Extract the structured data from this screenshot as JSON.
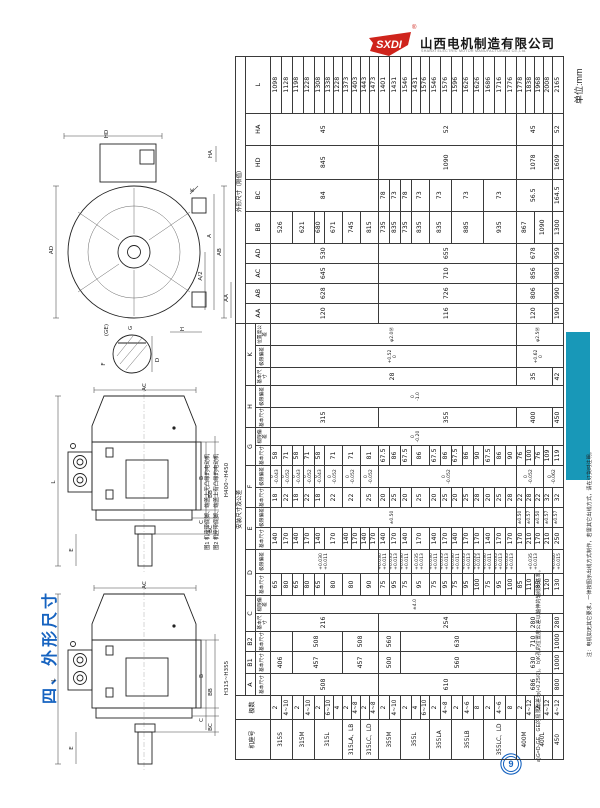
{
  "page": {
    "unit_label": "单位:mm",
    "section_title": "四、外形尺寸",
    "page_number": "9"
  },
  "logo": {
    "mark_text": "SXDI",
    "reg_mark": "®",
    "company_cn": "山西电机制造有限公司",
    "company_en": "SHANXI ELECTRIC MOTOR MANUFACTURING Co.,Ltd."
  },
  "colors": {
    "accent_blue": "#1663c0",
    "teal_bar": "#1898b8",
    "logo_red": "#cf241c"
  },
  "drawings": {
    "caption_line1": "图1 机座带底脚、端盖上无凸缘的电动机",
    "caption_line2": "图2 机座带底脚、端盖上有凸缘的电动机",
    "front_view": {
      "labels": {
        "hd": "HD",
        "ad": "AD",
        "ha": "HA",
        "k": "K",
        "ab": "AB",
        "a": "A",
        "a2": "A/2",
        "aa": "AA",
        "h": "H"
      }
    },
    "shaft_detail": {
      "labels": {
        "ge": "(GE)",
        "g": "G",
        "f": "F",
        "d": "D"
      }
    },
    "side_view_top": {
      "range_label": "H400~H450",
      "labels": {
        "ac": "AC",
        "l": "L",
        "e": "E",
        "b": "B",
        "bb": "BB",
        "c": "C",
        "bc": "BC"
      }
    },
    "side_view_bottom": {
      "range_label": "H315~H355",
      "labels": {
        "ac": "AC",
        "l": "L",
        "e": "E",
        "b": "B",
        "bb": "BB",
        "c": "C",
        "bc": "BC"
      }
    }
  },
  "notes": {
    "note_ab": "a)G=D-GE，GE的极限偏差为(+0.25/0)。 b)K孔的位置度公差以轴伸的轴线为基准。",
    "note_order": "注：电机如无其它要求，一律按图示出线方式制作，若需其它出线方式，请在订货时注明。"
  },
  "table": {
    "group_headers": {
      "install": "安装尺寸及公差",
      "overall": "外形尺寸（限值）"
    },
    "corner_headers": {
      "frame": "机座号",
      "poles": "极数"
    },
    "sub_labels": {
      "basic": "基本尺寸",
      "dev": "极限偏差",
      "pos": "位置度公差"
    },
    "letter_groups": [
      {
        "label": "A",
        "span": 1
      },
      {
        "label": "B1",
        "span": 1
      },
      {
        "label": "B2",
        "span": 1
      },
      {
        "label": "C",
        "span": 2
      },
      {
        "label": "D",
        "span": 2
      },
      {
        "label": "E",
        "span": 2
      },
      {
        "label": "F",
        "span": 2
      },
      {
        "label": "G",
        "span": 2
      },
      {
        "label": "H",
        "span": 2
      },
      {
        "label": "K",
        "span": 3
      }
    ],
    "overall_letters": [
      "AA",
      "AB",
      "AC",
      "AD",
      "BB",
      "BC",
      "HD",
      "HA",
      "L"
    ],
    "col_widths": [
      40,
      24,
      22,
      22,
      20,
      18,
      18,
      22,
      24,
      22,
      20,
      20,
      22,
      20,
      18,
      20,
      22,
      18,
      22,
      22,
      20,
      20,
      20,
      20,
      32,
      32,
      34,
      32,
      57
    ],
    "column_order": [
      "A",
      "B1",
      "B2",
      "C",
      "C_dev",
      "D",
      "D_dev",
      "E",
      "E_dev",
      "F",
      "F_dev",
      "G",
      "G_dev",
      "H",
      "H_dev",
      "K",
      "K_dev",
      "K_pos",
      "AA",
      "AB",
      "AC",
      "AD",
      "BB",
      "BC",
      "HD",
      "HA",
      "L"
    ],
    "frames": [
      {
        "name": "315S",
        "poles": [
          "2",
          "4~10"
        ]
      },
      {
        "name": "315M",
        "poles": [
          "2",
          "4~10"
        ]
      },
      {
        "name": "315L",
        "poles": [
          "2",
          "6~10",
          "4"
        ]
      },
      {
        "name": "315LA、LB",
        "poles": [
          "2",
          "4~8"
        ]
      },
      {
        "name": "315LC、LD",
        "poles": [
          "2",
          "4~8"
        ]
      },
      {
        "name": "355M",
        "poles": [
          "2",
          "4~10"
        ]
      },
      {
        "name": "355L",
        "poles": [
          "2",
          "4",
          "6~10"
        ]
      },
      {
        "name": "355LA",
        "poles": [
          "2",
          "4~8"
        ]
      },
      {
        "name": "355LB",
        "poles": [
          "2",
          "4~6",
          "8"
        ]
      },
      {
        "name": "355LC、LD",
        "poles": [
          "2",
          "4~6",
          "8"
        ]
      },
      {
        "name": "400M",
        "poles": [
          "2",
          "4~12"
        ]
      },
      {
        "name": "400L",
        "poles": [
          "2",
          "4~12"
        ]
      },
      {
        "name": "450",
        "poles": [
          "4~12"
        ]
      }
    ],
    "columns": {
      "A": [
        [
          "508",
          11
        ],
        [
          "610",
          13
        ],
        [
          "686",
          4
        ],
        [
          "800",
          1
        ]
      ],
      "B1": [
        [
          "406",
          2
        ],
        [
          "457",
          5
        ],
        [
          "457",
          4
        ],
        [
          "500",
          2
        ],
        [
          "560",
          11
        ],
        [
          "630",
          4
        ],
        [
          "1000",
          1
        ]
      ],
      "B2": [
        [
          "",
          2
        ],
        [
          "508",
          5
        ],
        [
          "508",
          4
        ],
        [
          "560",
          2
        ],
        [
          "630",
          11
        ],
        [
          "710",
          4
        ],
        [
          "1000",
          1
        ]
      ],
      "C": [
        [
          "216",
          11
        ],
        [
          "254",
          13
        ],
        [
          "280",
          4
        ],
        [
          "280",
          1
        ]
      ],
      "C_dev": [
        [
          "±4.0",
          29
        ]
      ],
      "D": [
        [
          "65",
          1
        ],
        [
          "80",
          1
        ],
        [
          "65",
          1
        ],
        [
          "80",
          1
        ],
        [
          "65",
          1
        ],
        [
          "80",
          2
        ],
        [
          "80",
          2
        ],
        [
          "90",
          2
        ],
        [
          "75",
          1
        ],
        [
          "95",
          1
        ],
        [
          "75",
          1
        ],
        [
          "95",
          2
        ],
        [
          "75",
          1
        ],
        [
          "95",
          1
        ],
        [
          "75",
          1
        ],
        [
          "95",
          1
        ],
        [
          "100",
          1
        ],
        [
          "75",
          1
        ],
        [
          "95",
          1
        ],
        [
          "100",
          1
        ],
        [
          "85",
          1
        ],
        [
          "110",
          1
        ],
        [
          "85",
          1
        ],
        [
          "120",
          1
        ],
        [
          "130",
          1
        ]
      ],
      "D_dev": [
        [
          "+0.030\n+0.011",
          11
        ],
        [
          "+0.030\n+0.011",
          1
        ],
        [
          "+0.035\n+0.013",
          1
        ],
        [
          "+0.030\n+0.011",
          1
        ],
        [
          "+0.035\n+0.013",
          2
        ],
        [
          "+0.030\n+0.011",
          1
        ],
        [
          "+0.035\n+0.013",
          1
        ],
        [
          "+0.030\n+0.011",
          1
        ],
        [
          "+0.035\n+0.013",
          1
        ],
        [
          "+0.035\n+0.013",
          1
        ],
        [
          "+0.030\n+0.011",
          1
        ],
        [
          "+0.035\n+0.013",
          1
        ],
        [
          "+0.035\n+0.013",
          1
        ],
        [
          "+0.035\n+0.013",
          4
        ],
        [
          "+0.040\n+0.015",
          1
        ]
      ],
      "E": [
        [
          "140",
          1
        ],
        [
          "170",
          1
        ],
        [
          "140",
          1
        ],
        [
          "170",
          1
        ],
        [
          "140",
          1
        ],
        [
          "170",
          2
        ],
        [
          "140",
          1
        ],
        [
          "170",
          1
        ],
        [
          "140",
          1
        ],
        [
          "170",
          1
        ],
        [
          "140",
          1
        ],
        [
          "170",
          1
        ],
        [
          "140",
          1
        ],
        [
          "170",
          2
        ],
        [
          "140",
          1
        ],
        [
          "170",
          1
        ],
        [
          "140",
          1
        ],
        [
          "170",
          1
        ],
        [
          "170",
          1
        ],
        [
          "140",
          1
        ],
        [
          "170",
          1
        ],
        [
          "170",
          1
        ],
        [
          "170",
          1
        ],
        [
          "210",
          1
        ],
        [
          "170",
          1
        ],
        [
          "210",
          1
        ],
        [
          "250",
          1
        ]
      ],
      "E_dev": [
        [
          "±0.50",
          24
        ],
        [
          "±0.50",
          1
        ],
        [
          "±0.57",
          1
        ],
        [
          "±0.50",
          1
        ],
        [
          "±0.57",
          1
        ],
        [
          "±0.57",
          1
        ]
      ],
      "F": [
        [
          "18",
          1
        ],
        [
          "22",
          1
        ],
        [
          "18",
          1
        ],
        [
          "22",
          1
        ],
        [
          "18",
          1
        ],
        [
          "22",
          2
        ],
        [
          "22",
          2
        ],
        [
          "25",
          2
        ],
        [
          "20",
          1
        ],
        [
          "25",
          1
        ],
        [
          "20",
          1
        ],
        [
          "25",
          2
        ],
        [
          "20",
          1
        ],
        [
          "25",
          1
        ],
        [
          "20",
          1
        ],
        [
          "25",
          1
        ],
        [
          "28",
          1
        ],
        [
          "20",
          1
        ],
        [
          "25",
          1
        ],
        [
          "28",
          1
        ],
        [
          "22",
          1
        ],
        [
          "28",
          1
        ],
        [
          "22",
          1
        ],
        [
          "32",
          1
        ],
        [
          "32",
          1
        ]
      ],
      "F_dev": [
        [
          "0\n-0.043",
          1
        ],
        [
          "0\n-0.052",
          1
        ],
        [
          "0\n-0.043",
          1
        ],
        [
          "0\n-0.052",
          1
        ],
        [
          "0\n-0.043",
          1
        ],
        [
          "0\n-0.052",
          2
        ],
        [
          "0\n-0.052",
          2
        ],
        [
          "0\n-0.052",
          2
        ],
        [
          "0\n-0.052",
          13
        ],
        [
          "0\n-0.052",
          3
        ],
        [
          "0\n-0.062",
          2
        ]
      ],
      "G": [
        [
          "58",
          1
        ],
        [
          "71",
          1
        ],
        [
          "58",
          1
        ],
        [
          "71",
          1
        ],
        [
          "58",
          1
        ],
        [
          "71",
          2
        ],
        [
          "71",
          2
        ],
        [
          "81",
          2
        ],
        [
          "67.5",
          1
        ],
        [
          "86",
          1
        ],
        [
          "67.5",
          1
        ],
        [
          "86",
          2
        ],
        [
          "67.5",
          1
        ],
        [
          "86",
          1
        ],
        [
          "67.5",
          1
        ],
        [
          "86",
          1
        ],
        [
          "90",
          1
        ],
        [
          "67.5",
          1
        ],
        [
          "86",
          1
        ],
        [
          "90",
          1
        ],
        [
          "76",
          1
        ],
        [
          "100",
          1
        ],
        [
          "76",
          1
        ],
        [
          "109",
          1
        ],
        [
          "119",
          1
        ]
      ],
      "G_dev": [
        [
          "0\n-0.20",
          29
        ]
      ],
      "H": [
        [
          "315",
          11
        ],
        [
          "355",
          13
        ],
        [
          "400",
          4
        ],
        [
          "450",
          1
        ]
      ],
      "H_dev": [
        [
          "0\n-1.0",
          29
        ]
      ],
      "K": [
        [
          "28",
          24
        ],
        [
          "35",
          4
        ],
        [
          "42",
          1
        ]
      ],
      "K_dev": [
        [
          "+0.52\n0",
          24
        ],
        [
          "+0.62\n0",
          5
        ]
      ],
      "K_pos": [
        [
          "φ2.0Ⓜ",
          24
        ],
        [
          "φ2.5Ⓜ",
          5
        ]
      ],
      "AA": [
        [
          "120",
          11
        ],
        [
          "116",
          13
        ],
        [
          "120",
          4
        ],
        [
          "190",
          1
        ]
      ],
      "AB": [
        [
          "628",
          11
        ],
        [
          "726",
          13
        ],
        [
          "806",
          4
        ],
        [
          "990",
          1
        ]
      ],
      "AC": [
        [
          "645",
          11
        ],
        [
          "710",
          13
        ],
        [
          "856",
          4
        ],
        [
          "980",
          1
        ]
      ],
      "AD": [
        [
          "530",
          11
        ],
        [
          "655",
          13
        ],
        [
          "678",
          4
        ],
        [
          "959",
          1
        ]
      ],
      "BB": [
        [
          "526",
          2
        ],
        [
          "621",
          2
        ],
        [
          "680",
          1
        ],
        [
          "671",
          2
        ],
        [
          "745",
          2
        ],
        [
          "815",
          2
        ],
        [
          "735",
          1
        ],
        [
          "835",
          1
        ],
        [
          "735",
          1
        ],
        [
          "835",
          2
        ],
        [
          "835",
          2
        ],
        [
          "885",
          3
        ],
        [
          "935",
          3
        ],
        [
          "867",
          2
        ],
        [
          "1090",
          2
        ],
        [
          "1300",
          1
        ]
      ],
      "BC": [
        [
          "84",
          11
        ],
        [
          "78",
          1
        ],
        [
          "73",
          1
        ],
        [
          "78",
          1
        ],
        [
          "73",
          2
        ],
        [
          "73",
          2
        ],
        [
          "73",
          3
        ],
        [
          "73",
          3
        ],
        [
          "56.5",
          4
        ],
        [
          "164.5",
          1
        ]
      ],
      "HD": [
        [
          "845",
          11
        ],
        [
          "1090",
          13
        ],
        [
          "1078",
          4
        ],
        [
          "1609",
          1
        ]
      ],
      "HA": [
        [
          "45",
          11
        ],
        [
          "52",
          13
        ],
        [
          "45",
          4
        ],
        [
          "52",
          1
        ]
      ],
      "L": [
        [
          "1098",
          1
        ],
        [
          "1128",
          1
        ],
        [
          "1198",
          1
        ],
        [
          "1228",
          1
        ],
        [
          "1308",
          1
        ],
        [
          "1338",
          1
        ],
        [
          "1228",
          1
        ],
        [
          "1373",
          1
        ],
        [
          "1403",
          1
        ],
        [
          "1443",
          1
        ],
        [
          "1473",
          1
        ],
        [
          "1401",
          1
        ],
        [
          "1431",
          1
        ],
        [
          "1546",
          1
        ],
        [
          "1431",
          1
        ],
        [
          "1576",
          1
        ],
        [
          "1546",
          1
        ],
        [
          "1576",
          1
        ],
        [
          "1596",
          1
        ],
        [
          "1626",
          1
        ],
        [
          "1626",
          1
        ],
        [
          "1686",
          1
        ],
        [
          "1716",
          1
        ],
        [
          "1776",
          1
        ],
        [
          "1778",
          1
        ],
        [
          "1838",
          1
        ],
        [
          "1968",
          1
        ],
        [
          "2008",
          1
        ],
        [
          "2165",
          1
        ]
      ]
    }
  }
}
